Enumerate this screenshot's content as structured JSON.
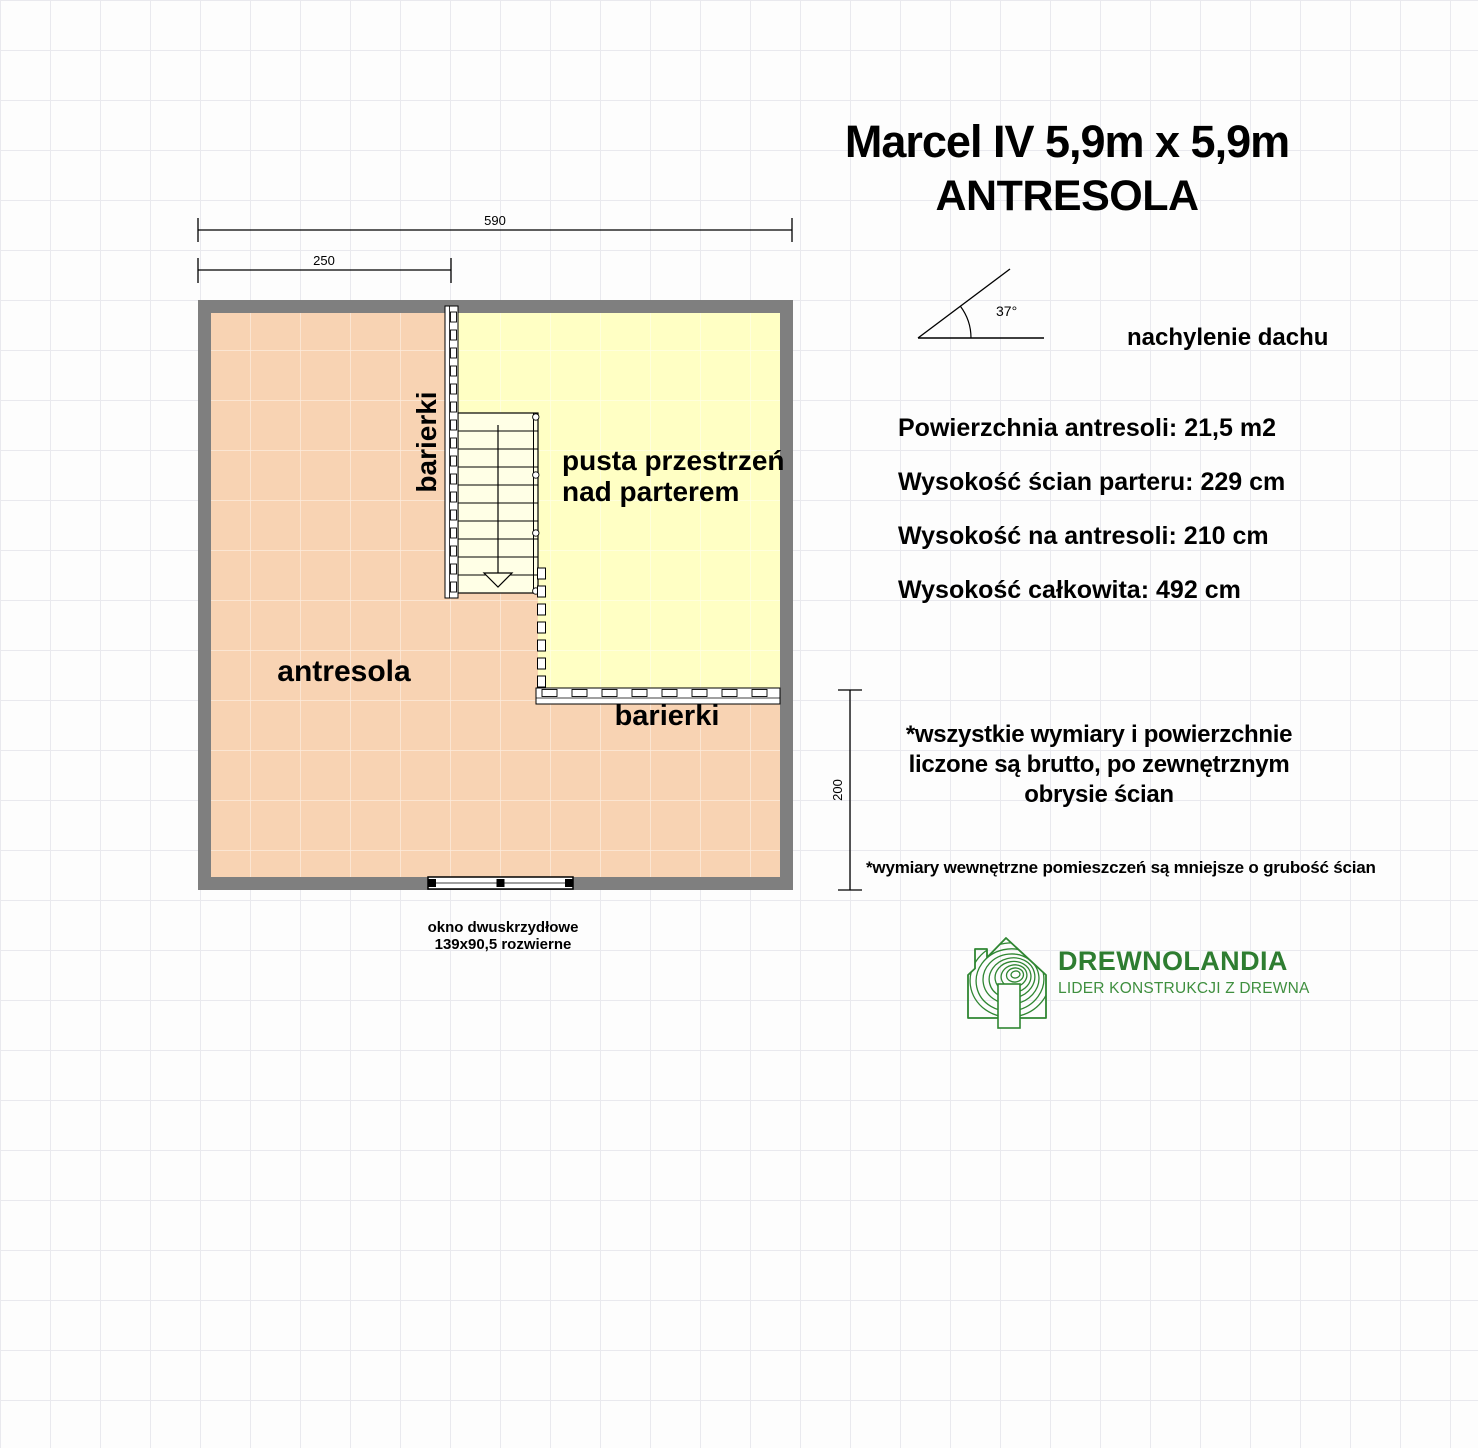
{
  "title": {
    "line1": "Marcel IV 5,9m x 5,9m",
    "line2": "ANTRESOLA"
  },
  "roof": {
    "angle_label": "37°",
    "caption": "nachylenie dachu"
  },
  "specs": [
    {
      "label": "Powierzchnia antresoli:",
      "value": "21,5 m2"
    },
    {
      "label": "Wysokość ścian parteru:",
      "value": "229 cm"
    },
    {
      "label": "Wysokość na antresoli:",
      "value": "210 cm"
    },
    {
      "label": "Wysokość całkowita:",
      "value": "492 cm"
    }
  ],
  "plan": {
    "dim_top": "590",
    "dim_inner": "250",
    "dim_side": "200",
    "label_antresola": "antresola",
    "label_barierki_left": "barierki",
    "label_barierki_bottom": "barierki",
    "label_void_line1": "pusta przestrzeń",
    "label_void_line2": "nad parterem",
    "window_line1": "okno dwuskrzydłowe",
    "window_line2": "139x90,5 rozwierne"
  },
  "notes": {
    "main_line1": "*wszystkie wymiary i powierzchnie",
    "main_line2": "liczone są brutto, po zewnętrznym",
    "main_line3": "obrysie ścian",
    "secondary": "*wymiary wewnętrzne pomieszczeń są mniejsze o grubość ścian"
  },
  "logo": {
    "name": "DREWNOLANDIA",
    "tagline": "LIDER KONSTRUKCJI Z DREWNA"
  },
  "colors": {
    "wall": "#7F7F7F",
    "antresola_fill": "#F8D3B3",
    "void_fill": "#FFFFC4",
    "stair_fill": "#FFFFE6",
    "logo_green": "#2E7D31",
    "logo_green_light": "#3F8F3F"
  }
}
